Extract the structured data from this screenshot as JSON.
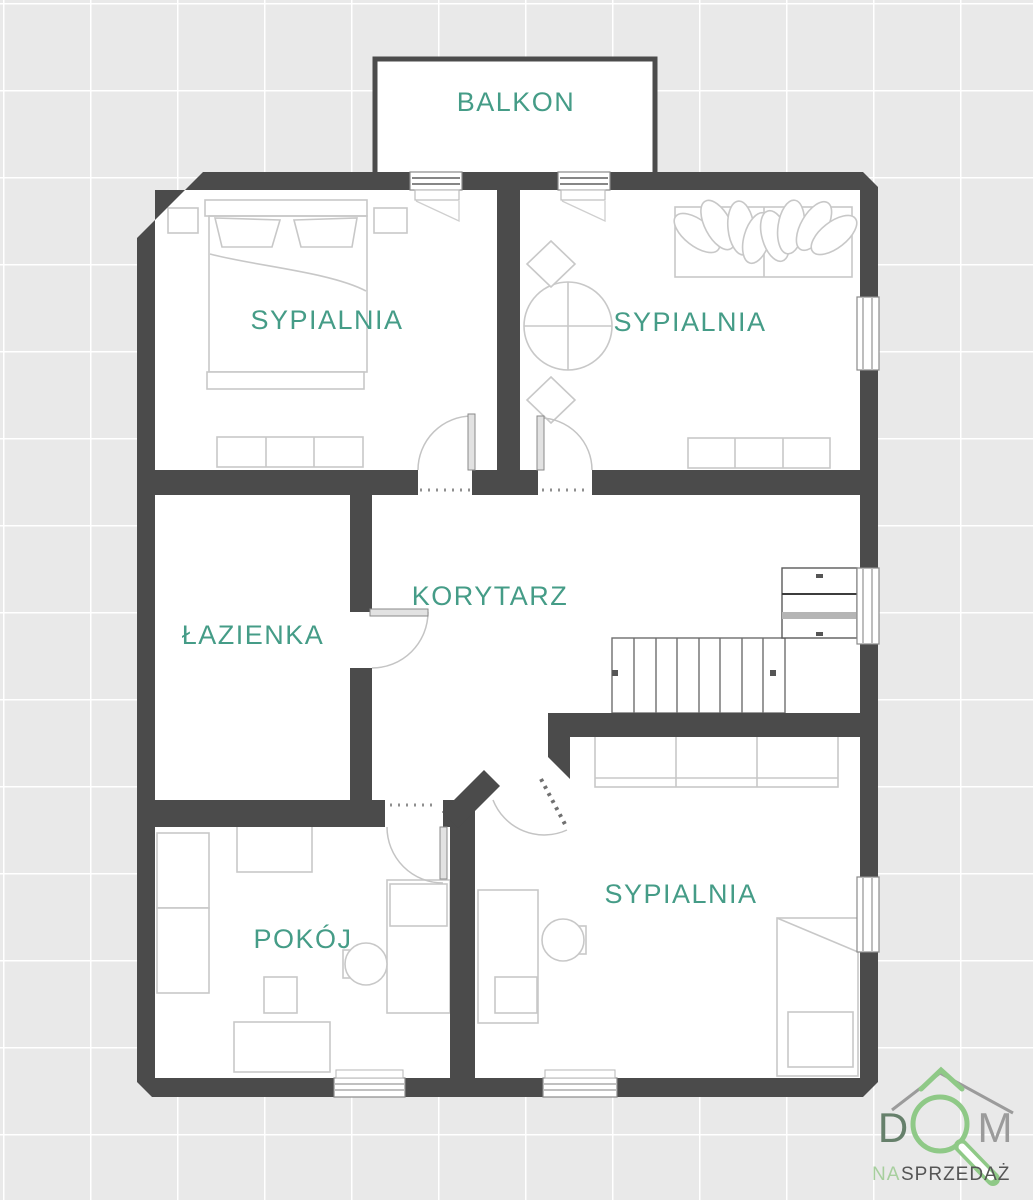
{
  "plan": {
    "rooms": [
      {
        "id": "balkon",
        "label": "BALKON"
      },
      {
        "id": "sypialnia-1",
        "label": "SYPIALNIA"
      },
      {
        "id": "sypialnia-2",
        "label": "SYPIALNIA"
      },
      {
        "id": "lazienka",
        "label": "ŁAZIENKA"
      },
      {
        "id": "korytarz",
        "label": "KORYTARZ"
      },
      {
        "id": "pokoj",
        "label": "POKÓJ"
      },
      {
        "id": "sypialnia-3",
        "label": "SYPIALNIA"
      }
    ]
  },
  "logo": {
    "word_d": "D",
    "word_m": "M",
    "subtitle_na": "NA",
    "subtitle_rest": "SPRZEDAŻ",
    "icons": {
      "roof": "house-roof-icon",
      "magnifier": "magnifying-glass-icon"
    }
  },
  "colors": {
    "background": "#e9e9e9",
    "grid_line": "#ffffff",
    "wall": "#4b4b4b",
    "floor": "#ffffff",
    "furniture_line": "#c8c8c8",
    "door_line": "#bdbdbd",
    "threshold_dots": "#8f8f8f",
    "label_text": "#459c87",
    "logo_green": "#8fc987",
    "logo_dark_green": "#66806b",
    "logo_gray": "#9b9b9b",
    "logo_subtitle_gray": "#555555"
  }
}
